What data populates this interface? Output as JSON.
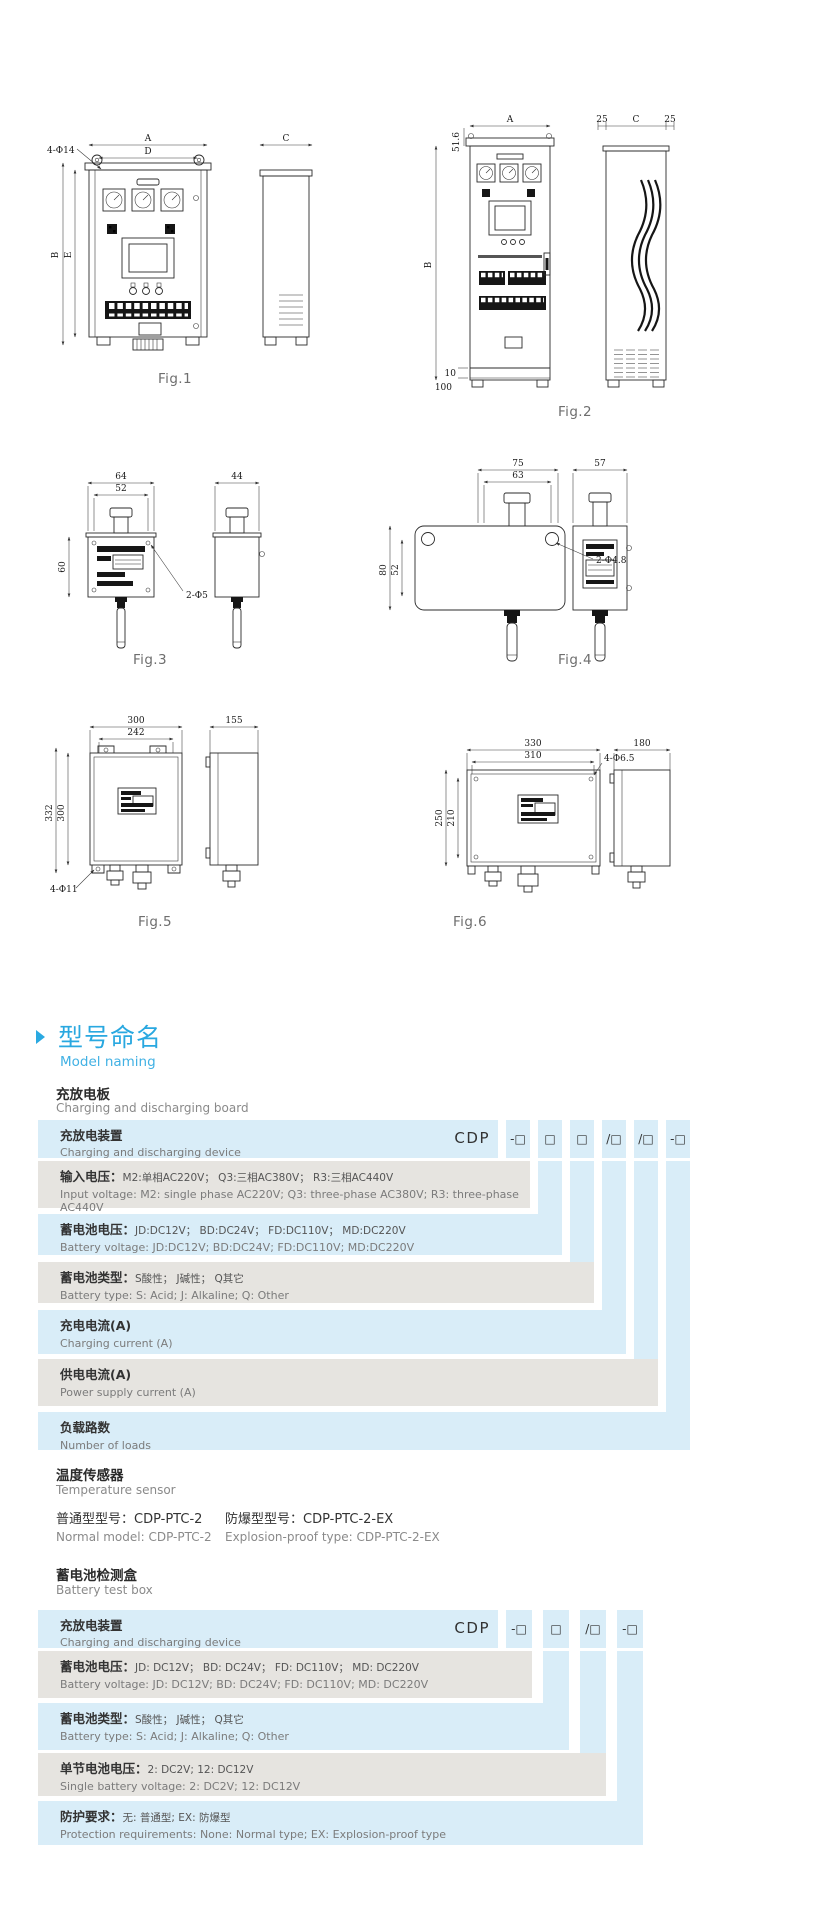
{
  "page": {
    "background": "#ffffff",
    "accent_blue": "#29a8e0",
    "row_blue": "#d9edf8",
    "row_gray": "#e6e4e0"
  },
  "figures": {
    "fig1": {
      "caption": "Fig.1",
      "dims": {
        "a": "A",
        "d": "D",
        "b": "B",
        "e": "E",
        "c": "C",
        "holes": "4-Φ14"
      }
    },
    "fig2": {
      "caption": "Fig.2",
      "dims": {
        "a": "A",
        "b": "B",
        "c": "C",
        "bracket": "51.6",
        "left": "25",
        "right": "25",
        "foot": "10",
        "base": "100"
      }
    },
    "fig3": {
      "caption": "Fig.3",
      "dims": {
        "w": "64",
        "iw": "52",
        "h": "60",
        "holes": "2-Φ5",
        "sw": "44"
      }
    },
    "fig4": {
      "caption": "Fig.4",
      "dims": {
        "w": "75",
        "iw": "63",
        "h": "80",
        "ih": "52",
        "holes": "2-Φ4.8",
        "sw": "57"
      }
    },
    "fig5": {
      "caption": "Fig.5",
      "dims": {
        "w": "300",
        "iw": "242",
        "h": "332",
        "ih": "300",
        "holes": "4-Φ11",
        "sw": "155"
      }
    },
    "fig6": {
      "caption": "Fig.6",
      "dims": {
        "w": "330",
        "iw": "310",
        "h": "250",
        "ih": "210",
        "holes": "4-Φ6.5",
        "sw": "180"
      }
    }
  },
  "section": {
    "title_zh": "型号命名",
    "title_en": "Model naming"
  },
  "board": {
    "title_zh": "充放电板",
    "title_en": "Charging and discharging board"
  },
  "table1": {
    "prefix": "CDP",
    "codes": [
      "-□",
      "□",
      "□",
      "/□",
      "/□",
      "-□"
    ],
    "rows": [
      {
        "zh": "充放电装置",
        "detail": "",
        "en": "Charging and discharging device"
      },
      {
        "zh": "输入电压：",
        "detail": "M2:单相AC220V； Q3:三相AC380V； R3:三相AC440V",
        "en": "Input voltage: M2: single phase AC220V; Q3: three-phase AC380V; R3: three-phase AC440V"
      },
      {
        "zh": "蓄电池电压：",
        "detail": "JD:DC12V； BD:DC24V； FD:DC110V； MD:DC220V",
        "en": "Battery voltage: JD:DC12V; BD:DC24V; FD:DC110V; MD:DC220V"
      },
      {
        "zh": "蓄电池类型：",
        "detail": "S酸性； J碱性； Q其它",
        "en": "Battery type: S: Acid; J: Alkaline; Q: Other"
      },
      {
        "zh": "充电电流(A)",
        "detail": "",
        "en": "Charging current (A)"
      },
      {
        "zh": "供电电流(A)",
        "detail": "",
        "en": "Power supply current (A)"
      },
      {
        "zh": "负载路数",
        "detail": "",
        "en": "Number of loads"
      }
    ]
  },
  "sensor": {
    "title_zh": "温度传感器",
    "title_en": "Temperature sensor",
    "normal_zh": "普通型型号：",
    "normal_model": "CDP-PTC-2",
    "normal_en": "Normal model: CDP-PTC-2",
    "ex_zh": "防爆型型号：",
    "ex_model": "CDP-PTC-2-EX",
    "ex_en": "Explosion-proof type: CDP-PTC-2-EX"
  },
  "testbox": {
    "title_zh": "蓄电池检测盒",
    "title_en": "Battery test box"
  },
  "table2": {
    "prefix": "CDP",
    "codes": [
      "-□",
      "□",
      "/□",
      "-□"
    ],
    "rows": [
      {
        "zh": "充放电装置",
        "detail": "",
        "en": "Charging and discharging device"
      },
      {
        "zh": "蓄电池电压：",
        "detail": "JD: DC12V； BD: DC24V； FD: DC110V； MD: DC220V",
        "en": "Battery voltage: JD: DC12V; BD: DC24V; FD: DC110V; MD: DC220V"
      },
      {
        "zh": "蓄电池类型：",
        "detail": "S酸性； J碱性； Q其它",
        "en": "Battery type: S: Acid; J: Alkaline; Q: Other"
      },
      {
        "zh": "单节电池电压：",
        "detail": "2: DC2V; 12: DC12V",
        "en": "Single battery voltage:  2: DC2V; 12: DC12V"
      },
      {
        "zh": "防护要求：",
        "detail": "无: 普通型; EX: 防爆型",
        "en": "Protection requirements:  None: Normal type; EX: Explosion-proof type"
      }
    ]
  }
}
